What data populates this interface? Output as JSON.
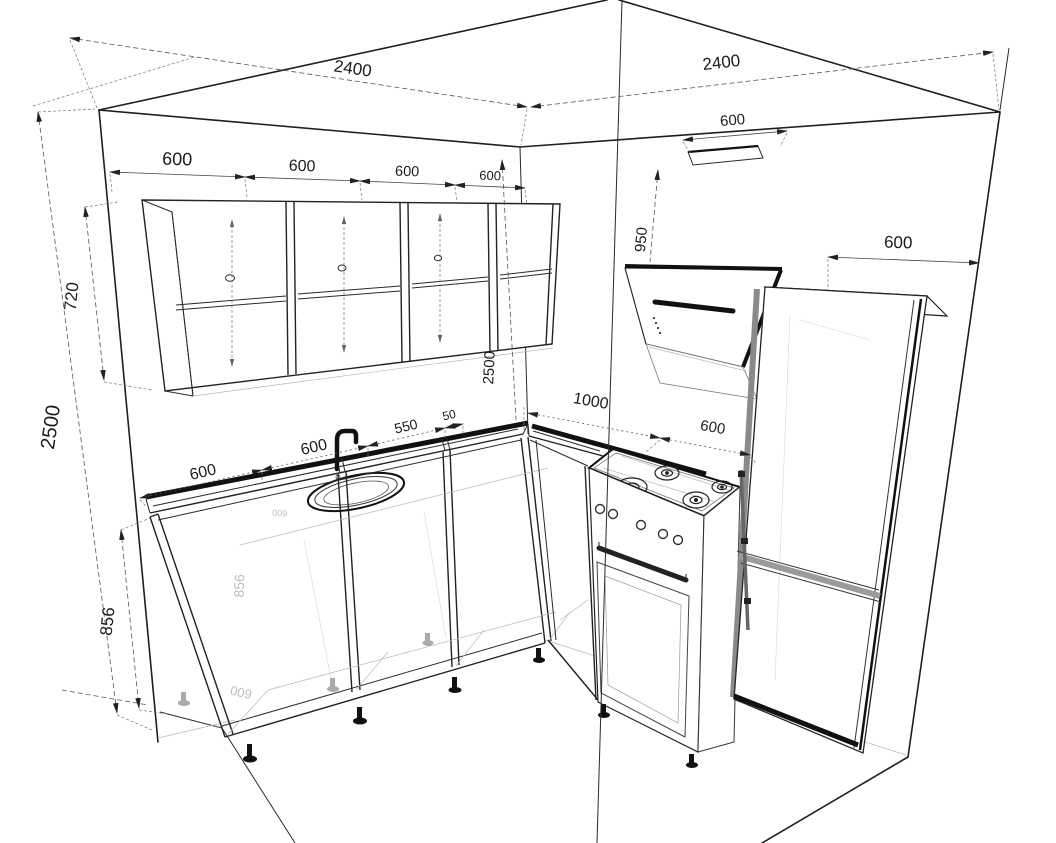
{
  "drawing": {
    "title": "kitchen-corner-perspective-dimension-drawing",
    "units": "mm",
    "line_color": "#1e1e1e",
    "background": "#ffffff"
  },
  "labels": {
    "top_left_wall": "2400",
    "top_right_wall": "2400",
    "upper_cabs": [
      "600",
      "600",
      "600",
      "600"
    ],
    "left_height": "2500",
    "upper_height": "720",
    "base_height": "856",
    "counter": [
      "600",
      "600",
      "550",
      "50"
    ],
    "right_run": [
      "1000",
      "600"
    ],
    "hood_width": "600",
    "hood_height": "950",
    "corner_height": "2500",
    "fridge_width": "600",
    "ghosts": [
      "856",
      "600",
      "600",
      "600",
      "856"
    ]
  }
}
